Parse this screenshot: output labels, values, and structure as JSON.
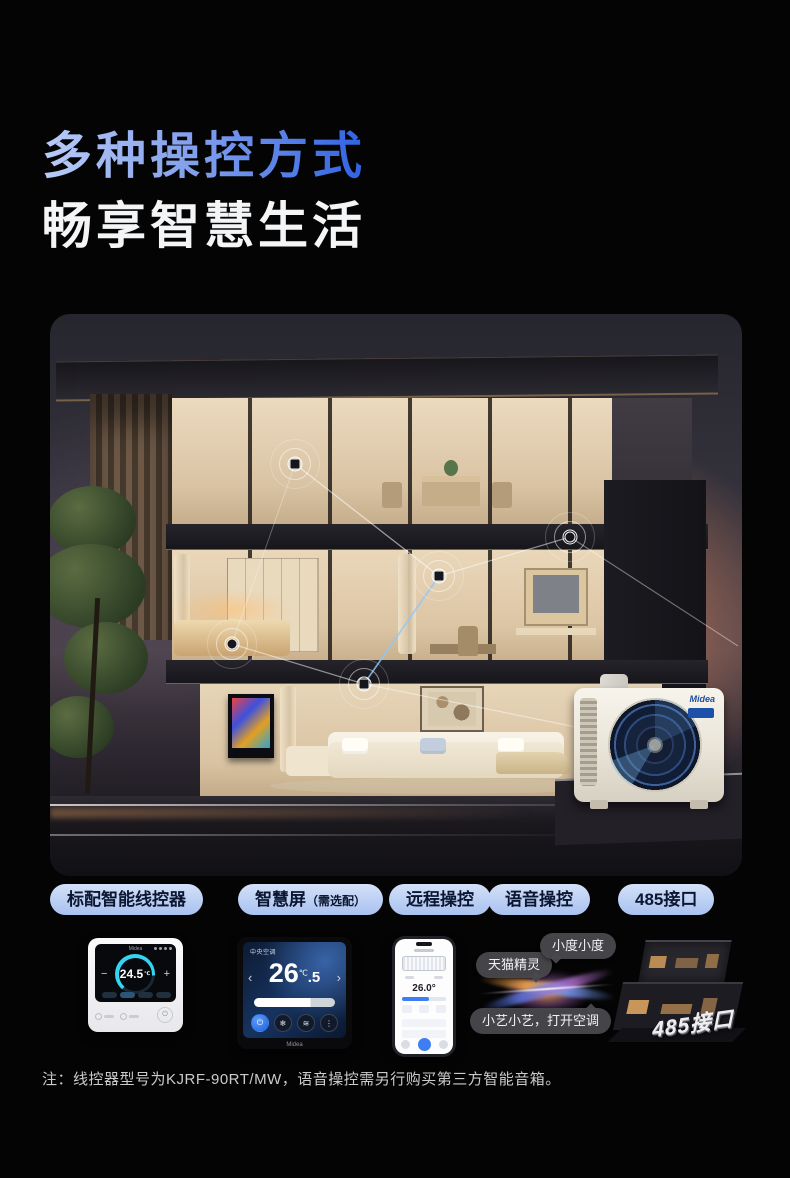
{
  "header": {
    "title_line1": "多种操控方式",
    "title_line2": "畅享智慧生活"
  },
  "features": [
    {
      "label": "标配智能线控器",
      "suffix": ""
    },
    {
      "label": "智慧屏",
      "suffix": "（需选配）"
    },
    {
      "label": "远程操控",
      "suffix": ""
    },
    {
      "label": "语音操控",
      "suffix": ""
    },
    {
      "label": "485接口",
      "suffix": ""
    }
  ],
  "wired_controller": {
    "brand": "Midea",
    "temp": "24.5",
    "unit": "℃",
    "minus": "−",
    "plus": "+",
    "power": "⏻"
  },
  "smart_screen": {
    "room": "中央空调",
    "temp_int": "26",
    "temp_dec": ".5",
    "unit": "℃",
    "left_arrow": "‹",
    "right_arrow": "›",
    "power": "⏻",
    "brand": "Midea"
  },
  "phone": {
    "temp": "26.0°"
  },
  "voice": {
    "tmall": "天猫精灵",
    "xiaodu": "小度小度",
    "xiaoyi": "小艺小艺，打开空调"
  },
  "port485": {
    "label": "485接口"
  },
  "outdoor": {
    "brand": "Midea"
  },
  "footnote": "注：线控器型号为KJRF-90RT/MW，语音操控需另行购买第三方智能音箱。",
  "colors": {
    "title_gradient_start": "#b9ccf6",
    "title_gradient_end": "#2f62e2",
    "pill_text": "#0c1631",
    "accent_blue": "#3f7ef2",
    "accent_cyan": "#35d4f2"
  }
}
